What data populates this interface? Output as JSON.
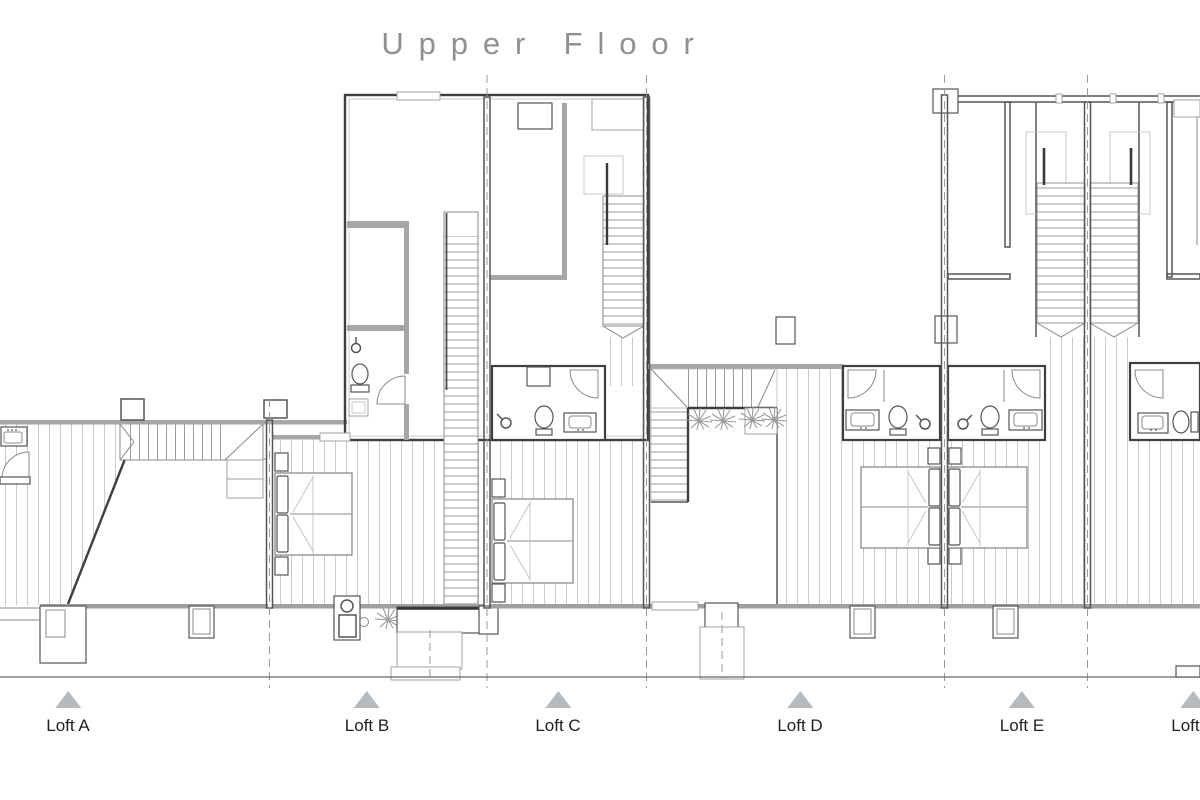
{
  "title": "Upper Floor",
  "units": {
    "items": [
      {
        "id": "loft-a",
        "label": "Loft A"
      },
      {
        "id": "loft-b",
        "label": "Loft B"
      },
      {
        "id": "loft-c",
        "label": "Loft C"
      },
      {
        "id": "loft-d",
        "label": "Loft D"
      },
      {
        "id": "loft-e",
        "label": "Loft E"
      },
      {
        "id": "loft-f",
        "label": "Loft F"
      }
    ]
  },
  "colors": {
    "background": "#ffffff",
    "title_text": "#8d9094",
    "label_text": "#1f1f1f",
    "marker": "#b7babd",
    "walls": "#3f3f3f",
    "deck_hatch": "#c5c5c5"
  }
}
